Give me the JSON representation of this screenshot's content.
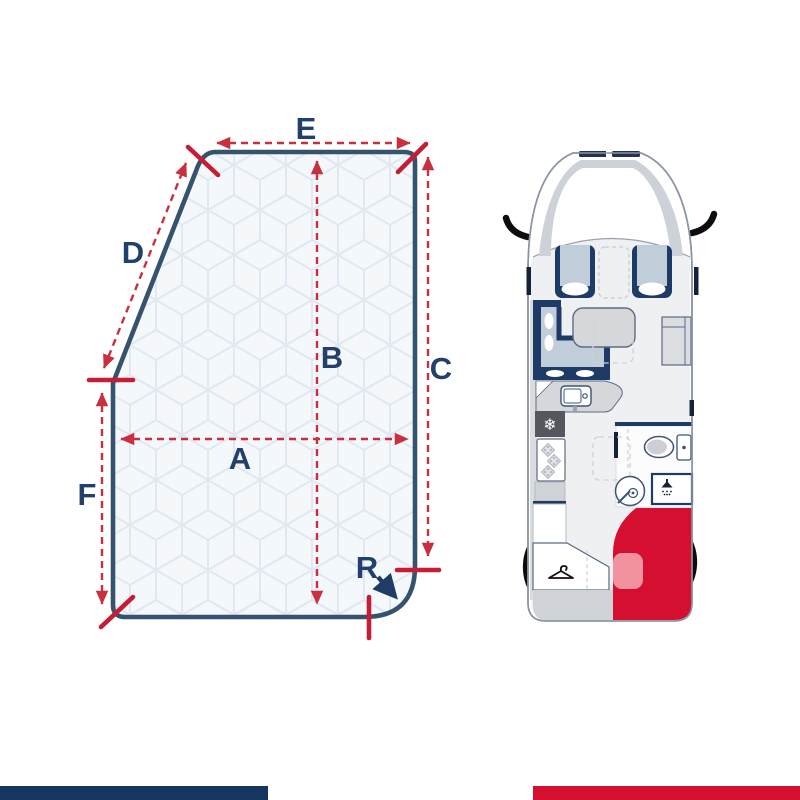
{
  "figure_title": "",
  "dimension_diagram": {
    "labels": {
      "A": "A",
      "B": "B",
      "C": "C",
      "D": "D",
      "E": "E",
      "F": "F",
      "R": "R"
    },
    "dimension_ids": [
      "A",
      "B",
      "C",
      "D",
      "E",
      "F",
      "R"
    ],
    "colors": {
      "outline_navy": "#35536f",
      "label_navy": "#21406b",
      "dimension_red": "#c9303f",
      "tick_red": "#c41d35",
      "mattress_fill": "#f5f8fb",
      "quilt_pattern_blue": "#e2e8f1"
    }
  },
  "floorplan": {
    "colors": {
      "body_outline": "#8b94a3",
      "furniture_navy": "#1e3a66",
      "cushion_blue": "#c2cdda",
      "furniture_gray": "#d5d7db",
      "fridge_dark_gray": "#54575d",
      "bed_highlight_red": "#d50f2f",
      "mattress_highlight_pink": "#f2919f"
    },
    "icons": {
      "snowflake": {
        "name": "snowflake-icon",
        "glyph": "❄"
      },
      "shower": {
        "name": "shower-head-icon"
      },
      "hanger": {
        "name": "hanger-icon"
      },
      "burner": {
        "name": "stove-burner-icon"
      }
    }
  },
  "footer": {
    "left_bar_color": "#16355f",
    "right_bar_color": "#d50f2f"
  }
}
